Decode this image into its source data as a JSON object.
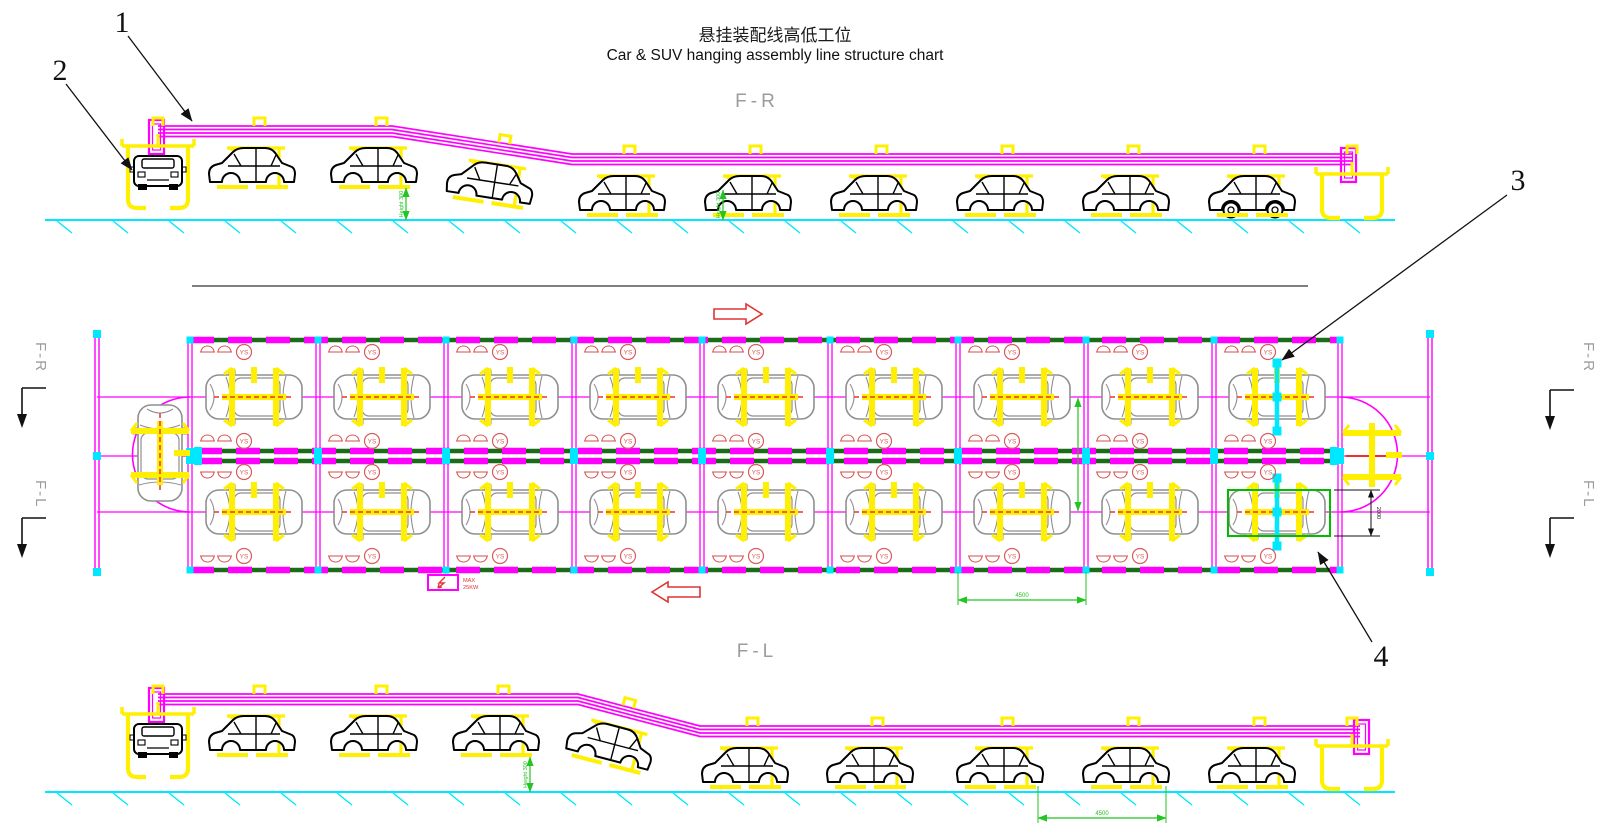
{
  "title": {
    "zh": "悬挂装配线高低工位",
    "en": "Car & SUV hanging assembly line structure chart"
  },
  "view_labels": {
    "top": "F-R",
    "bottom": "F-L"
  },
  "section_markers": {
    "left_top": "F-R",
    "left_bottom": "F-L",
    "right_top": "F-R",
    "right_bottom": "F-L"
  },
  "callouts": [
    {
      "num": "1"
    },
    {
      "num": "2"
    },
    {
      "num": "3"
    },
    {
      "num": "4"
    }
  ],
  "plan": {
    "ys_label": "YS",
    "bays": 9,
    "rows": 2
  },
  "power_label": {
    "line1": "MAX",
    "line2": "25KW"
  },
  "dimensions": {
    "hanger_height": "Height 300",
    "bay_span": "4500",
    "station_width": "2000"
  },
  "colors": {
    "magenta": "#ff00ff",
    "yellow": "#ffef00",
    "cyan": "#00e8ff",
    "red": "#e03434",
    "ys_red": "#d95b5b",
    "dim_green": "#22c522",
    "rail_green": "#1a6b1a",
    "car_gray": "#8f8f8f",
    "label_gray": "#9c9c9c",
    "black": "#111111"
  }
}
